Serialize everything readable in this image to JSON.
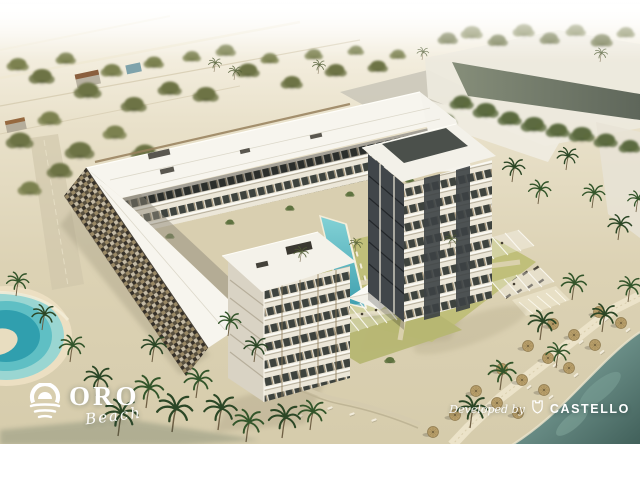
{
  "branding": {
    "project": {
      "icon": "sun-waves-icon",
      "wordmark": "ORO",
      "tagline": "Beach"
    },
    "developer": {
      "credit_prefix": "Developed by",
      "icon": "castle-shield-icon",
      "wordmark": "CASTELLO"
    }
  },
  "palette": {
    "sky_white": "#ffffff",
    "sand_light": "#e9e0c8",
    "sand_mid": "#dcd2b3",
    "sand_shade": "#c8bda0",
    "roof_white": "#f6f4ee",
    "facade_cream": "#ece7d9",
    "facade_charcoal": "#3c4144",
    "wood_accent": "#9b8a66",
    "lawn_green": "#bdbd77",
    "palm_green": "#2e4a28",
    "tree_olive": "#7c814f",
    "courtyard_pool_turquoise": "#4fb6bf",
    "lagoon_turquoise": "#43b0ba",
    "sea_deep": "#4a6a64",
    "sea_shore": "#8fb3a7",
    "umbrella_straw": "#b79d69",
    "logo_white": "#ffffff"
  }
}
